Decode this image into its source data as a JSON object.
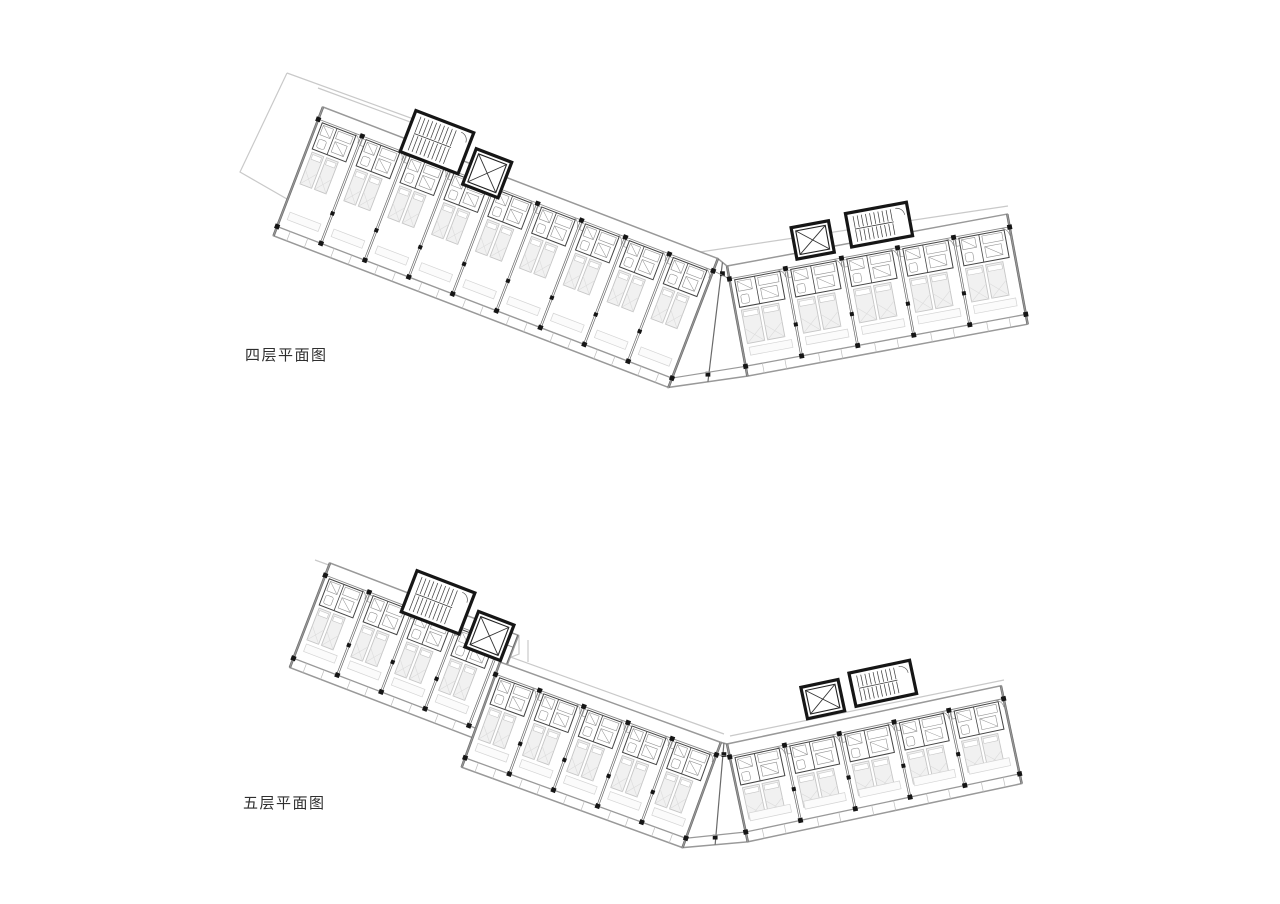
{
  "page": {
    "width": 1280,
    "height": 904,
    "background": "#ffffff"
  },
  "colors": {
    "band_outline": "#999999",
    "band_fill": "#ffffff",
    "light_outline": "#c9c9c9",
    "partition": "#6a6a6a",
    "corridor_line": "#8a8a8a",
    "detail": "#8f8f8f",
    "furniture_fill": "#f1f1f1",
    "furniture_stroke": "#c6c6c6",
    "pod_stroke": "#444444",
    "fixture": "#909090",
    "heavy_wall": "#161616",
    "column": "#161616",
    "label_color": "#2f2f2f"
  },
  "plans": [
    {
      "id": "floor-plan-4",
      "label": "四层平面图",
      "label_pos": {
        "x": 245,
        "y": 344
      },
      "light_outlines": [
        [
          [
            287,
            73
          ],
          [
            452,
            133
          ],
          [
            407,
            268
          ],
          [
            240,
            172
          ],
          [
            287,
            73
          ]
        ],
        [
          [
            318,
            88
          ],
          [
            470,
            144
          ]
        ],
        [
          [
            700,
            252
          ],
          [
            1008,
            206
          ]
        ]
      ],
      "wings": [
        {
          "x": 323,
          "y": 107,
          "angle": 21,
          "modules": 9,
          "module_w": 47,
          "depth": 138,
          "end_extra": 0
        },
        {
          "x": 727,
          "y": 266,
          "angle": -10.5,
          "modules": 5,
          "module_w": 57,
          "depth": 112,
          "end_extra": 0,
          "joined": true
        }
      ],
      "cores": [
        {
          "wing": 0,
          "along": 88,
          "dy": -30,
          "w": 62,
          "h": 44,
          "type": "stair"
        },
        {
          "wing": 0,
          "along": 158,
          "dy": -16,
          "w": 38,
          "h": 38,
          "type": "elevator"
        },
        {
          "wing": 1,
          "along": 70,
          "dy": -26,
          "w": 38,
          "h": 32,
          "type": "elevator"
        },
        {
          "wing": 1,
          "along": 126,
          "dy": -30,
          "w": 62,
          "h": 34,
          "type": "stair"
        }
      ]
    },
    {
      "id": "floor-plan-5",
      "label": "五层平面图",
      "label_pos": {
        "x": 243,
        "y": 792
      },
      "light_outlines": [
        [
          [
            315,
            560
          ],
          [
            425,
            600
          ]
        ],
        [
          [
            502,
            654
          ],
          [
            724,
            734
          ]
        ],
        [
          [
            730,
            736
          ],
          [
            1004,
            680
          ]
        ],
        [
          [
            519,
            636
          ],
          [
            519,
            654
          ],
          [
            504,
            660
          ]
        ],
        [
          [
            528,
            640
          ],
          [
            528,
            662
          ]
        ]
      ],
      "wings": [
        {
          "x": 330,
          "y": 563,
          "angle": 21,
          "modules": 4,
          "module_w": 47,
          "depth": 112,
          "end_extra": 14
        },
        {
          "x": 500,
          "y": 662,
          "angle": 20,
          "modules": 5,
          "module_w": 47,
          "depth": 112,
          "end_extra": 0
        },
        {
          "x": 727,
          "y": 744,
          "angle": -12,
          "modules": 5,
          "module_w": 56,
          "depth": 100,
          "end_extra": 0,
          "joined": true
        }
      ],
      "cores": [
        {
          "wing": 0,
          "along": 84,
          "dy": -24,
          "w": 62,
          "h": 44,
          "type": "stair"
        },
        {
          "wing": 0,
          "along": 156,
          "dy": -8,
          "w": 38,
          "h": 38,
          "type": "elevator"
        },
        {
          "wing": 2,
          "along": 84,
          "dy": -40,
          "w": 38,
          "h": 32,
          "type": "elevator"
        },
        {
          "wing": 2,
          "along": 134,
          "dy": -44,
          "w": 62,
          "h": 34,
          "type": "stair"
        }
      ]
    }
  ]
}
